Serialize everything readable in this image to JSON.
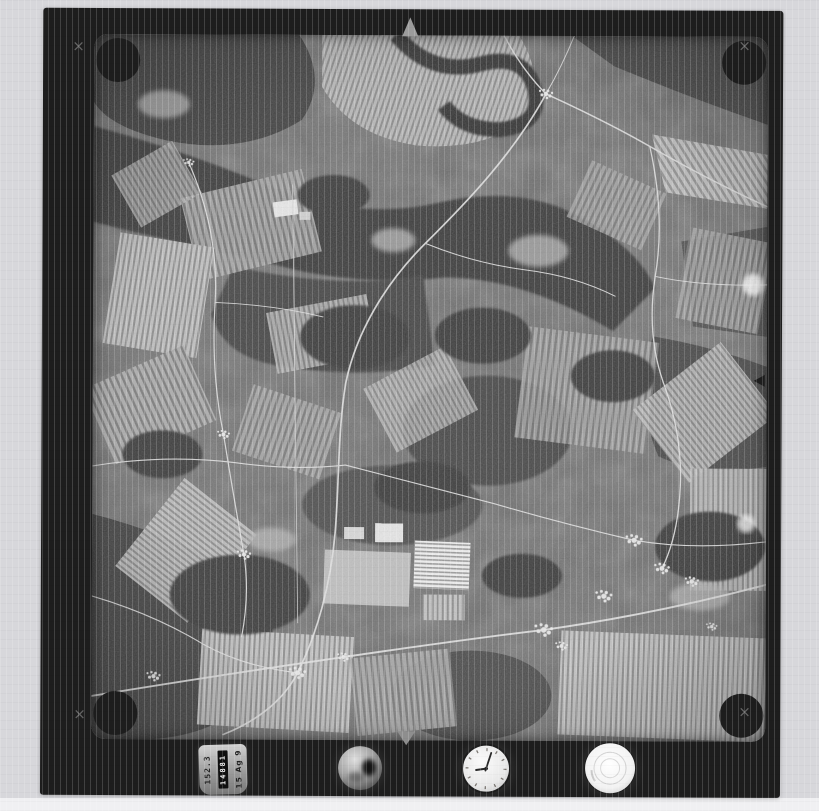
{
  "film": {
    "fiducial_corner_mark": "×"
  },
  "data_block": {
    "left_value": "152.3",
    "counter_value": "14881",
    "right_value": "15 Ag 9"
  },
  "clock": {
    "minute_hand_transform": "rotate(18)",
    "hour_hand_transform": "rotate(262)"
  },
  "colors": {
    "page-bg": "#d7d7db",
    "film-black": "#1d1d1d",
    "photo-base": "#6e6e6e",
    "bottom-strip": "#f0f0f2",
    "fiducial-gray": "#a0a0a0"
  }
}
